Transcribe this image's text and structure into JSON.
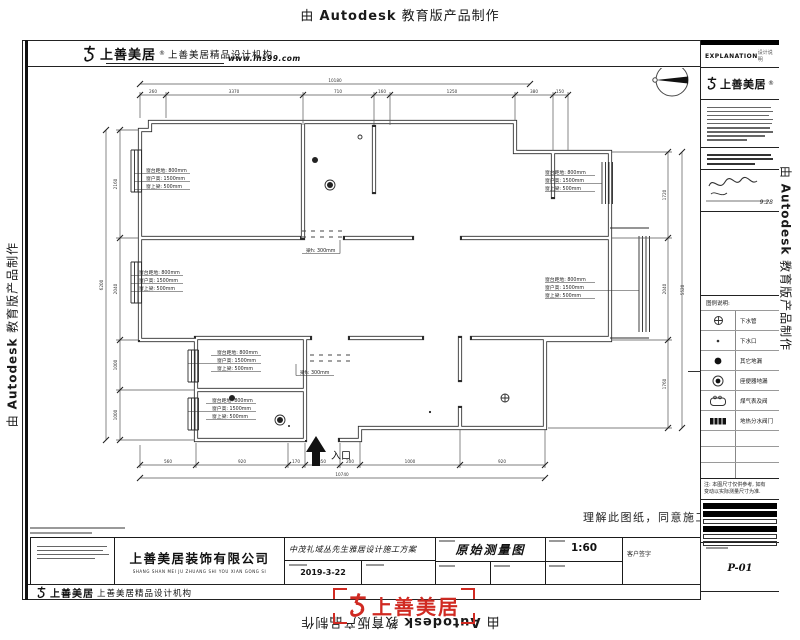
{
  "watermark": {
    "prefix": "由",
    "brand": "Autodesk",
    "suffix": "教育版产品制作"
  },
  "header": {
    "logo_name": "上善美居",
    "logo_reg": "®",
    "logo_sub": "上善美居精品设计机构",
    "website": "www.lhs99.com"
  },
  "right_panel": {
    "explanation": "EXPLANATION",
    "explanation_sub": "设计说明",
    "logo_name": "上善美居",
    "sign_date": "9.28",
    "legend_title": "图例说明:",
    "legend": [
      {
        "icon": "drain-pipe",
        "label": "下水管"
      },
      {
        "icon": "drain-outlet",
        "label": "下水口"
      },
      {
        "icon": "floor-drain",
        "label": "其它地漏"
      },
      {
        "icon": "toilet-drain",
        "label": "座便器地漏"
      },
      {
        "icon": "gas-meter",
        "label": "煤气表及阀"
      },
      {
        "icon": "heat-manifold",
        "label": "地热分水阀门"
      }
    ],
    "note_line1": "注: 本图尺寸仅供参考, 如有",
    "note_line2": "变动以实际测量尺寸为准.",
    "sheet_no": "P-01"
  },
  "plan": {
    "entrance": "入口",
    "agreement": "理解此图纸，同意施工",
    "window_note": {
      "l1": "窗台距地: 800mm",
      "l2": "窗户高: 1500mm",
      "l3": "窗上梁: 500mm"
    },
    "beam_note": "梁h: 300mm",
    "dims": {
      "top": [
        "260",
        "3370",
        "710",
        "160",
        "1250",
        "380",
        "150"
      ],
      "top_overall": "10180",
      "bottom": [
        "560",
        "920",
        "170",
        "350",
        "200",
        "1000",
        "920"
      ],
      "bottom_overall": "10740",
      "left": [
        "2160",
        "2040",
        "1000",
        "1000"
      ],
      "left_overall": "6200",
      "right": [
        "1720",
        "2040",
        "1760"
      ],
      "right_overall": "5520"
    }
  },
  "title_block": {
    "company": "上善美居装饰有限公司",
    "company_pinyin": "SHANG SHAN MEI JU ZHUANG SHI YOU XIAN GONG SI",
    "project": "中茂礼域丛先生雅居设计施工方案",
    "date": "2019-3-22",
    "drawing_title": "原始测量图",
    "scale": "1:60",
    "client_sign": "客户签字"
  },
  "footer": {
    "logo_name": "上善美居",
    "logo_sub": "上善美居精品设计机构"
  },
  "stamp": {
    "name": "上善美居"
  }
}
